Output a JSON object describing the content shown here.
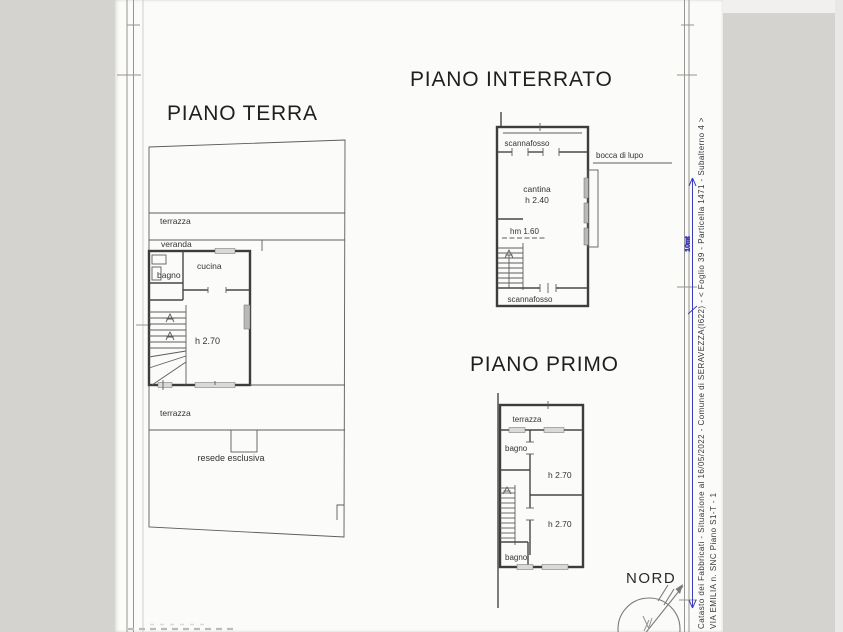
{
  "titles": {
    "ground_floor": "PIANO TERRA",
    "basement": "PIANO INTERRATO",
    "first_floor": "PIANO PRIMO"
  },
  "ground_floor": {
    "terrace_top": "terrazza",
    "veranda": "veranda",
    "bathroom": "bagno",
    "kitchen": "cucina",
    "room_height": "h 2.70",
    "terrace_bottom": "terrazza",
    "garden": "resede esclusiva"
  },
  "basement": {
    "crawlspace_top": "scannafosso",
    "light_well": "bocca di lupo",
    "cellar": "cantina",
    "cellar_height": "h 2.40",
    "mean_height": "hm 1.60",
    "crawlspace_bottom": "scannafosso"
  },
  "first_floor": {
    "terrace": "terrazza",
    "bathroom_top": "bagno",
    "room1_height": "h 2.70",
    "room2_height": "h 2.70",
    "bathroom_bottom": "bagno"
  },
  "compass": {
    "north_label": "NORD"
  },
  "sidebar": {
    "cadastral_line": "Catasto dei Fabbricati - Situazione al 16/05/2022 - Comune di SERAVEZZA(I622) - <  Foglio 39 - Particella  1471 - Subalterno 4 >",
    "address_line": "VIA EMILIA n. SNC Piano S1-T - 1",
    "dimension_label": "10mt"
  },
  "colors": {
    "background": "#d5d3d0",
    "paper": "#fbfbfa",
    "line": "#4a4a4a",
    "dimension_blue": "#3d3dbb"
  }
}
